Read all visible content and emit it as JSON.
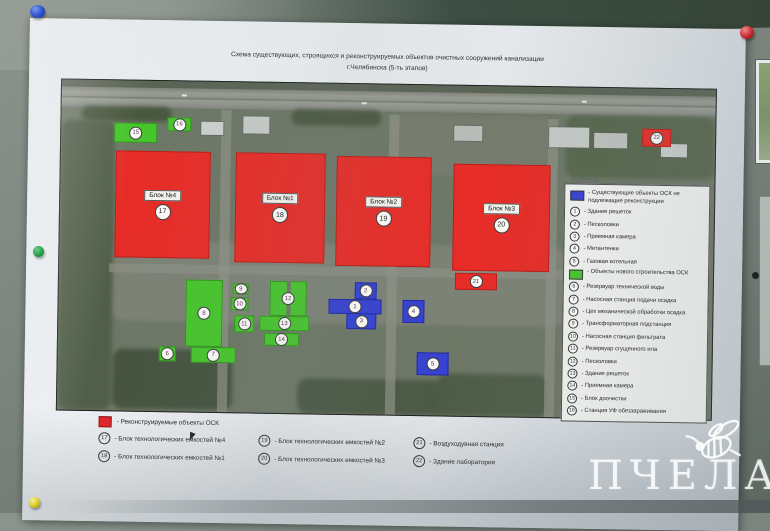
{
  "title": {
    "line1": "Схема существующих, строящихся и реконструируемых объектов очистных сооружений канализации",
    "line2": "г.Челябинска (5-ть этапов)"
  },
  "watermark": {
    "text": "ПЧЕЛА"
  },
  "map": {
    "colors": {
      "red": "#e72c27",
      "green": "#47c52c",
      "blue": "#3642d0"
    },
    "blocks": [
      {
        "type": "red",
        "num": "17",
        "label": "Блок №4",
        "x": 55,
        "y": 70,
        "w": 95,
        "h": 107
      },
      {
        "type": "red",
        "num": "18",
        "label": "Блок №1",
        "x": 175,
        "y": 70,
        "w": 90,
        "h": 110
      },
      {
        "type": "red",
        "num": "19",
        "label": "Блок №2",
        "x": 276,
        "y": 72,
        "w": 95,
        "h": 110
      },
      {
        "type": "red",
        "num": "20",
        "label": "Блок №3",
        "x": 393,
        "y": 78,
        "w": 97,
        "h": 107
      },
      {
        "type": "red",
        "num": "21",
        "x": 396,
        "y": 187,
        "w": 42,
        "h": 17
      },
      {
        "type": "red",
        "num": "22",
        "x": 581,
        "y": 40,
        "w": 29,
        "h": 18
      },
      {
        "type": "green",
        "num": "15",
        "x": 53,
        "y": 42,
        "w": 43,
        "h": 20
      },
      {
        "type": "green",
        "num": "16",
        "x": 106,
        "y": 36,
        "w": 24,
        "h": 14
      },
      {
        "type": "green",
        "num": "8",
        "x": 127,
        "y": 198,
        "w": 37,
        "h": 67
      },
      {
        "type": "green",
        "num": "9",
        "x": 174,
        "y": 201,
        "w": 16,
        "h": 11
      },
      {
        "type": "green",
        "num": "10",
        "x": 172,
        "y": 215,
        "w": 18,
        "h": 13
      },
      {
        "type": "green",
        "num": "11",
        "x": 176,
        "y": 233,
        "w": 20,
        "h": 17
      },
      {
        "type": "green",
        "num": "12",
        "x": 211,
        "y": 198,
        "w": 37,
        "h": 35,
        "gap": true
      },
      {
        "type": "green",
        "num": "13",
        "x": 201,
        "y": 233,
        "w": 50,
        "h": 15
      },
      {
        "type": "green",
        "num": "14",
        "x": 206,
        "y": 250,
        "w": 35,
        "h": 13
      },
      {
        "type": "green",
        "num": "6",
        "x": 101,
        "y": 265,
        "w": 17,
        "h": 15
      },
      {
        "type": "green",
        "num": "7",
        "x": 133,
        "y": 265,
        "w": 45,
        "h": 16
      },
      {
        "type": "blue",
        "num": "2",
        "x": 296,
        "y": 198,
        "w": 22,
        "h": 17
      },
      {
        "type": "blue",
        "num": "1",
        "x": 270,
        "y": 215,
        "w": 53,
        "h": 15
      },
      {
        "type": "blue",
        "num": "3",
        "x": 288,
        "y": 229,
        "w": 30,
        "h": 16
      },
      {
        "type": "blue",
        "num": "4",
        "x": 344,
        "y": 215,
        "w": 22,
        "h": 23
      },
      {
        "type": "blue",
        "num": "5",
        "x": 359,
        "y": 267,
        "w": 32,
        "h": 23
      }
    ]
  },
  "legend_right": {
    "existing_swatch_color": "#3642d0",
    "existing_label": "- Существующие объекты ОСК не подлежащие реконструкции",
    "existing_items": [
      {
        "num": "1",
        "label": "- Здание решеток"
      },
      {
        "num": "2",
        "label": "- Песколовки"
      },
      {
        "num": "3",
        "label": "- Приемная камера"
      },
      {
        "num": "4",
        "label": "- Метантенки"
      },
      {
        "num": "5",
        "label": "- Газовая котельная"
      }
    ],
    "new_swatch_color": "#47c52c",
    "new_label": "- Объекты нового строительства ОСК",
    "new_items": [
      {
        "num": "6",
        "label": "- Резервуар технической воды"
      },
      {
        "num": "7",
        "label": "- Насосная станция подачи осадка"
      },
      {
        "num": "8",
        "label": "- Цех механической обработки осадка"
      },
      {
        "num": "9",
        "label": "- Трансформаторная подстанция"
      },
      {
        "num": "10",
        "label": "- Насосная станция фильтрата"
      },
      {
        "num": "11",
        "label": "- Резервуар сгущенного ила"
      },
      {
        "num": "12",
        "label": "- Песколовки"
      },
      {
        "num": "13",
        "label": "- Здание решеток"
      },
      {
        "num": "14",
        "label": "- Приемная камера"
      },
      {
        "num": "15",
        "label": "- Блок доочистки"
      },
      {
        "num": "16",
        "label": "- Станция УФ обеззараживания"
      }
    ]
  },
  "legend_bottom": {
    "recon_swatch_color": "#e32227",
    "recon_label": "- Реконструируемые объекты ОСК",
    "items": [
      {
        "num": "17",
        "label": "- Блок технологических емкостей №4"
      },
      {
        "num": "18",
        "label": "- Блок технологических емкостей №1"
      },
      {
        "num": "19",
        "label": "- Блок технологических емкостей №2"
      },
      {
        "num": "20",
        "label": "- Блок технологических емкостей №3"
      },
      {
        "num": "21",
        "label": "- Воздуходувная станция"
      },
      {
        "num": "22",
        "label": "- Здание лаборатории"
      }
    ]
  }
}
